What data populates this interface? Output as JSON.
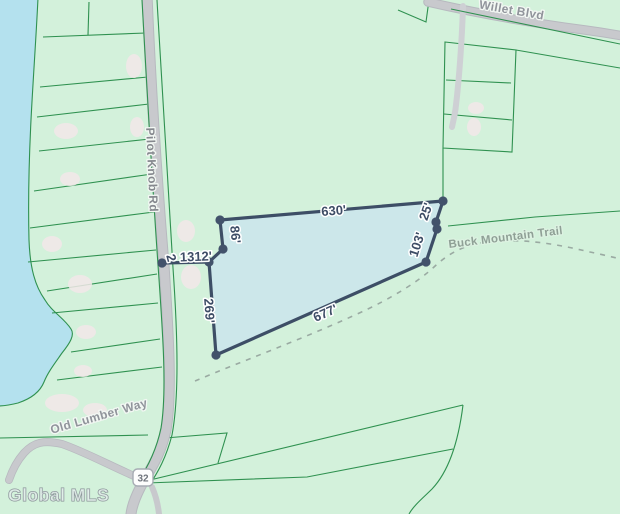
{
  "map": {
    "watermark": "Global MLS",
    "route_shield": "32",
    "roads": [
      {
        "name": "Pilot Knob Rd"
      },
      {
        "name": "Willet Blvd"
      },
      {
        "name": "Buck Mountain Trail"
      },
      {
        "name": "Old Lumber Way"
      }
    ],
    "parcel": {
      "dimensions": [
        {
          "side": "north",
          "label": "630'"
        },
        {
          "side": "northeast",
          "label": "25'"
        },
        {
          "side": "east",
          "label": "103'"
        },
        {
          "side": "south",
          "label": "677'"
        },
        {
          "side": "west",
          "label": "269'"
        },
        {
          "side": "northwest",
          "label": "86'"
        },
        {
          "side": "road-spur",
          "label": "1312'"
        },
        {
          "side": "road-spur-partial",
          "label": "2"
        }
      ]
    },
    "colors": {
      "land": "#d3f1db",
      "water": "#b4e1ee",
      "parcel_line": "#2f9150",
      "road_fill": "#c8c9cd",
      "boundary_stroke": "#3d4e66",
      "boundary_fill": "#cbe6eb",
      "dimension_text": "#3e4d66",
      "road_label_text": "#90949b"
    }
  }
}
